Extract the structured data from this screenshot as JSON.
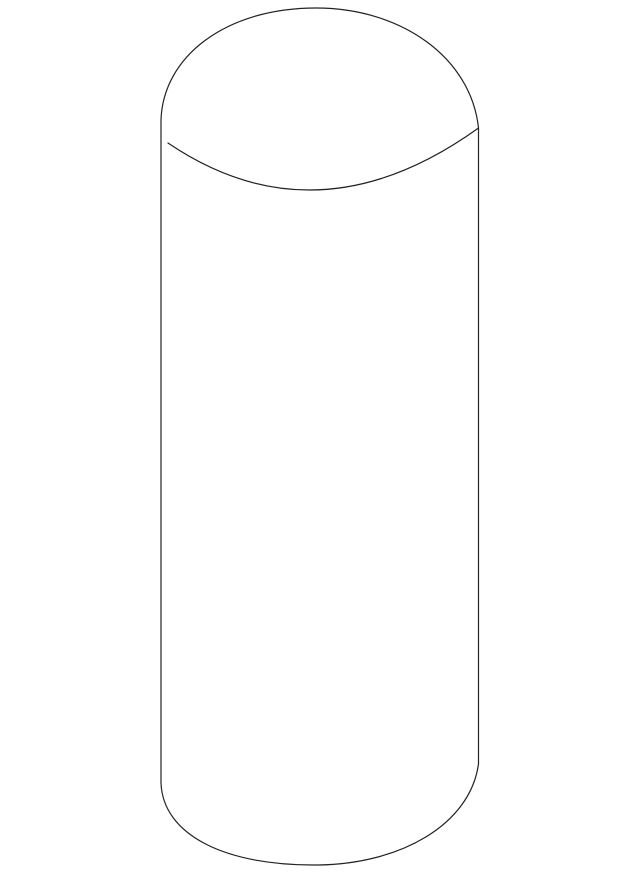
{
  "canvas": {
    "width": 640,
    "height": 877,
    "viewbox": "0 0 640 877",
    "background_color": "#ffffff"
  },
  "figure": {
    "kind": "parts-catalog line illustration",
    "subject": "cylindrical part with domed top (cap / pin / cylinder)",
    "line_color": "#222222",
    "line_width": "1.2",
    "body_fill_color": "#ffffff",
    "outline_path": "M 161 783 L 161 120 C 163 57 225 8 316 8 C 402 8 471 58 478.5 128 L 478.5 764 C 470 825 400 864 318 865 C 225 866 163 835 161 783 Z",
    "top_edge_path": "M 168 143 Q 317 244 478.5 128"
  }
}
